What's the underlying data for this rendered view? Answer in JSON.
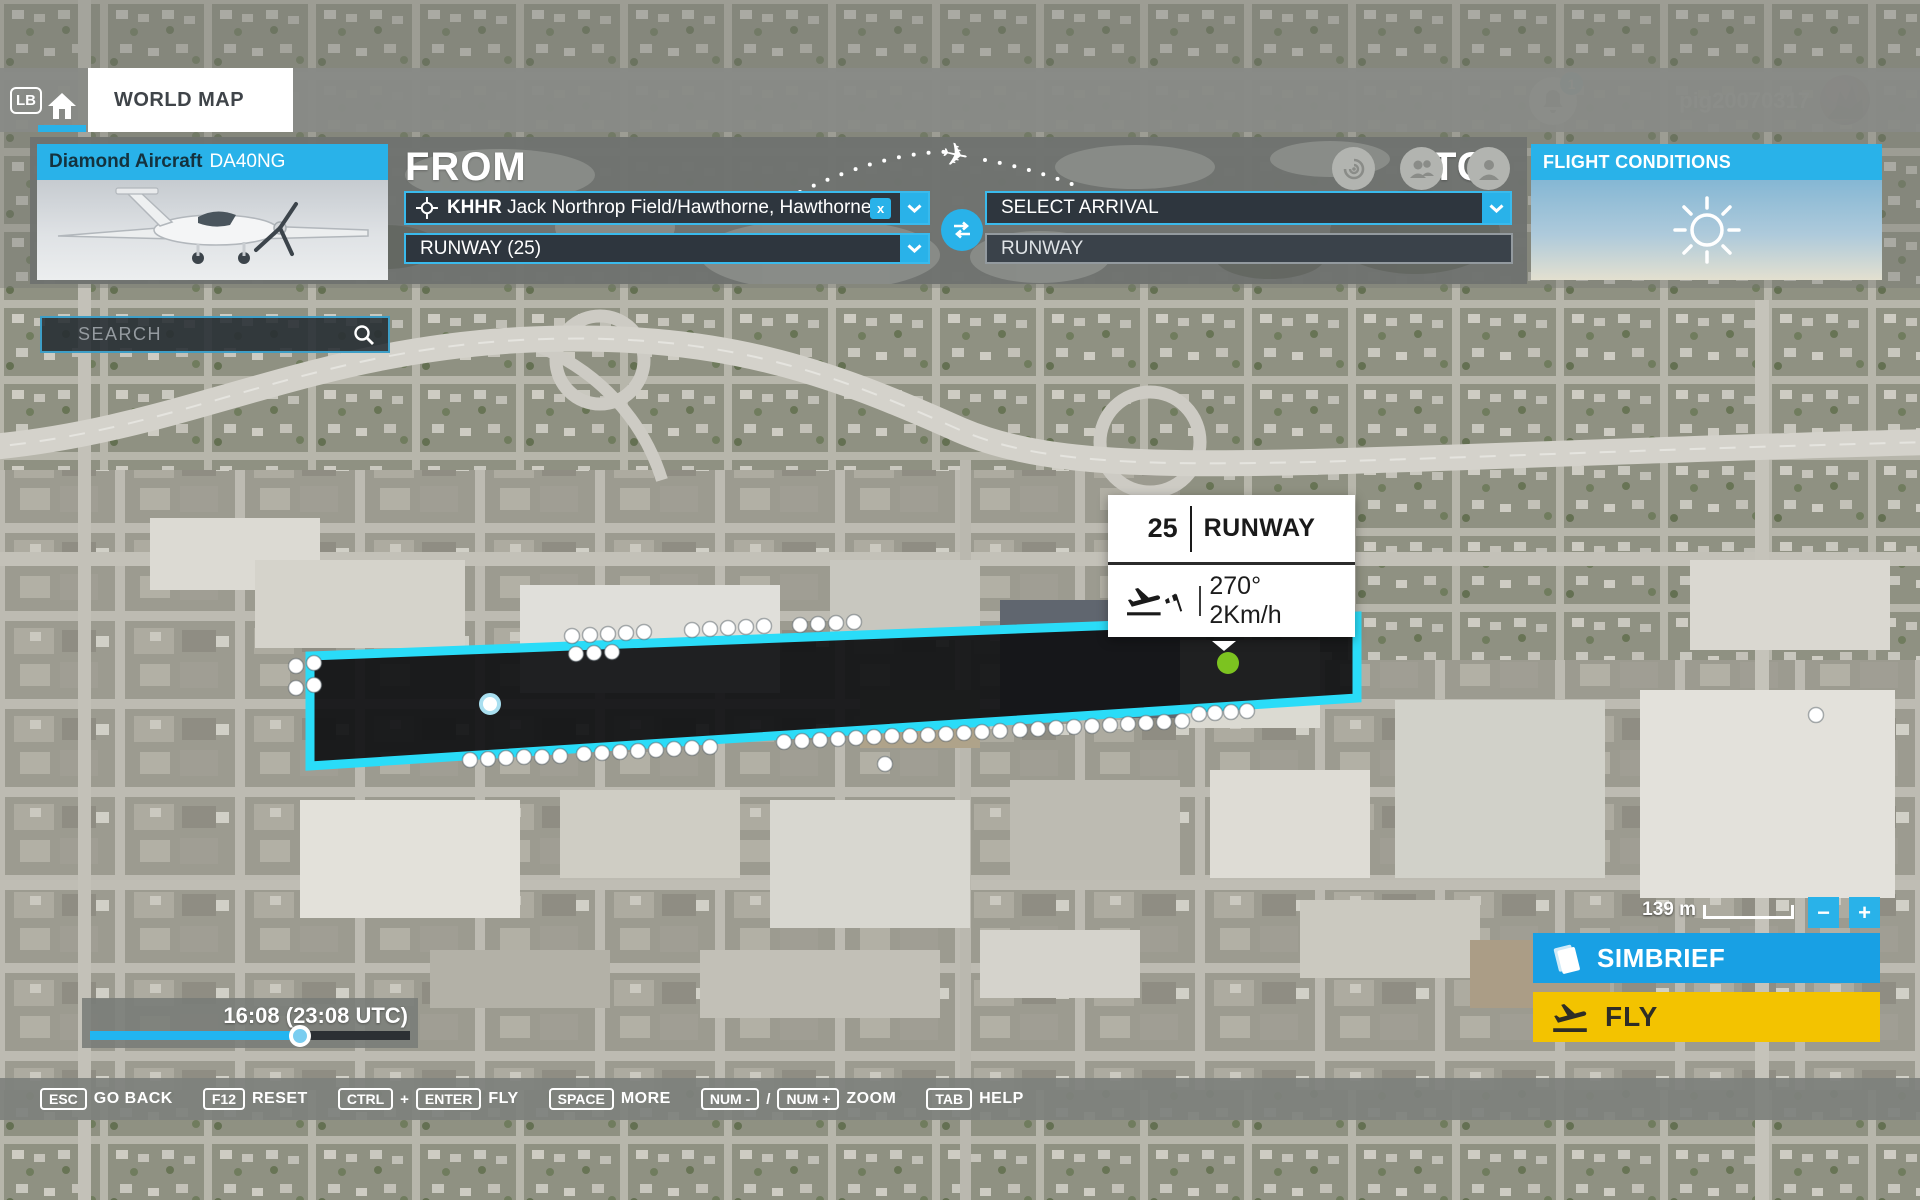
{
  "colors": {
    "accent": "#29b2e9",
    "field_border": "#3abaec",
    "runway_cyan": "#2adcf8",
    "simbrief_blue": "#18a0e4",
    "fly_yellow": "#f3c300",
    "spawn_green": "#7cc320",
    "popup_text": "#1a1a1a"
  },
  "topbar": {
    "lb_badge": "LB",
    "world_map_tab": "WORLD MAP",
    "notification_count": "1",
    "username": "pig20070317"
  },
  "aircraft_panel": {
    "maker": "Diamond Aircraft",
    "model": "DA40NG"
  },
  "flight_conditions": {
    "title": "FLIGHT CONDITIONS"
  },
  "from": {
    "label": "FROM",
    "departure_code": "KHHR",
    "departure_name": "Jack Northrop Field/Hawthorne, Hawthorne",
    "clear_glyph": "x",
    "runway_value": "RUNWAY (25)"
  },
  "to": {
    "label": "TO",
    "arrival_placeholder": "SELECT ARRIVAL",
    "runway_placeholder": "RUNWAY"
  },
  "search": {
    "placeholder": "SEARCH"
  },
  "runway_popup": {
    "number": "25",
    "title": "RUNWAY",
    "wind": "270° 2Km/h"
  },
  "map_controls": {
    "scale_label": "139 m",
    "zoom_out_glyph": "−",
    "zoom_in_glyph": "+"
  },
  "action_buttons": {
    "simbrief": "SIMBRIEF",
    "fly": "FLY"
  },
  "time_slider": {
    "value": "16:08 (23:08 UTC)",
    "progress_pct": 65.5
  },
  "shortcut_bar": {
    "items": [
      {
        "keys": [
          "ESC"
        ],
        "join": "",
        "label": "GO BACK"
      },
      {
        "keys": [
          "F12"
        ],
        "join": "",
        "label": "RESET"
      },
      {
        "keys": [
          "CTRL",
          "ENTER"
        ],
        "join": "+",
        "label": "FLY"
      },
      {
        "keys": [
          "SPACE"
        ],
        "join": "",
        "label": "MORE"
      },
      {
        "keys": [
          "NUM -",
          "NUM +"
        ],
        "join": "/",
        "label": "ZOOM"
      },
      {
        "keys": [
          "TAB"
        ],
        "join": "",
        "label": "HELP"
      }
    ]
  },
  "icons": {
    "home": "home-icon",
    "radar": "radar-icon",
    "friends": "friends-icon",
    "profile": "person-icon",
    "notifications": "bell-icon",
    "locate": "crosshair-icon",
    "clear": "x-icon",
    "dropdown": "chevron-down-icon",
    "swap": "swap-horizontal-icon",
    "sun": "sun-icon",
    "magnifier": "search-icon",
    "takeoff": "flight-takeoff-icon",
    "windsock": "windsock-icon",
    "briefing": "briefing-doc-icon",
    "zoom_out": "minus-icon",
    "zoom_in": "plus-icon",
    "plane_route": "airplane-icon"
  }
}
